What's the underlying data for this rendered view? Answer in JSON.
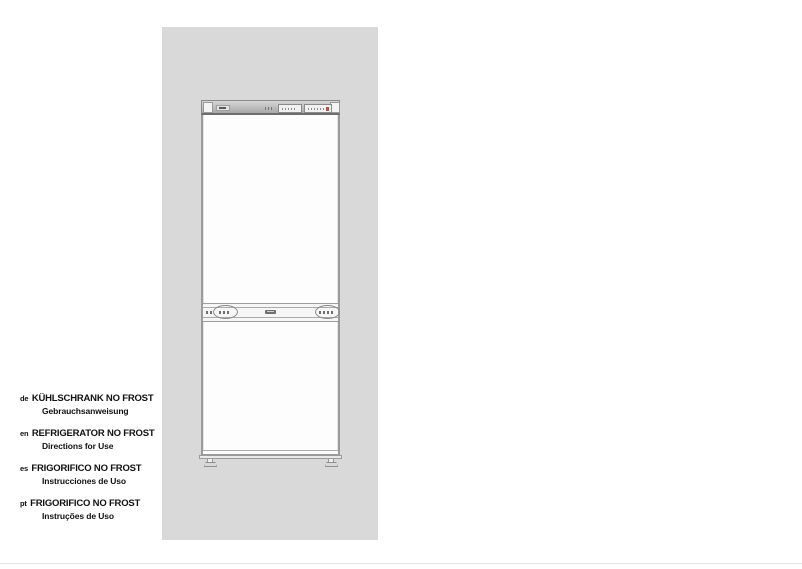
{
  "cover": {
    "panel_color": "#d9d9d9",
    "languages": [
      {
        "code": "de",
        "title": "KÜHLSCHRANK NO FROST",
        "subtitle": "Gebrauchsanweisung"
      },
      {
        "code": "en",
        "title": "REFRIGERATOR NO FROST",
        "subtitle": "Directions for Use"
      },
      {
        "code": "es",
        "title": "FRIGORIFICO NO FROST",
        "subtitle": "Instrucciones de Uso"
      },
      {
        "code": "pt",
        "title": "FRIGORIFICO NO FROST",
        "subtitle": "Instruções de Uso"
      }
    ]
  },
  "illustration": {
    "subject": "fridge-freezer-front-view",
    "indicator_dot_color": "#b0514a"
  },
  "page": {
    "bottom_rule_color": "#e4e4e4"
  }
}
